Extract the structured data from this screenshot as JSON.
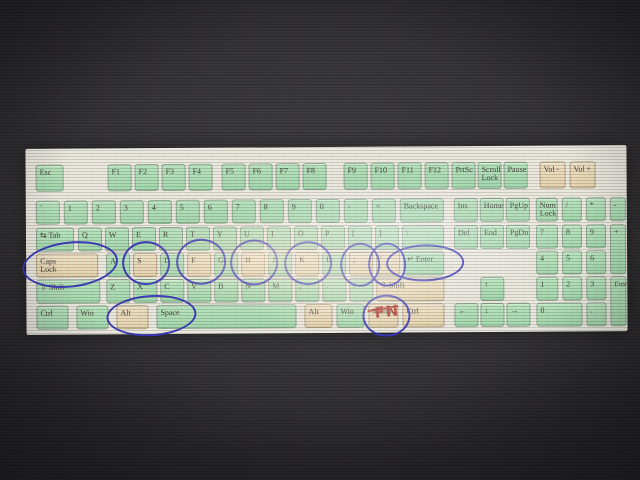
{
  "keyboard": {
    "keys": [
      {
        "id": "esc",
        "label": "Esc",
        "x": 10,
        "y": 16,
        "w": 28,
        "h": 27,
        "c": "g"
      },
      {
        "id": "f1",
        "label": "F1",
        "x": 82,
        "y": 16,
        "w": 24,
        "h": 27,
        "c": "g"
      },
      {
        "id": "f2",
        "label": "F2",
        "x": 109,
        "y": 16,
        "w": 24,
        "h": 27,
        "c": "g"
      },
      {
        "id": "f3",
        "label": "F3",
        "x": 136,
        "y": 16,
        "w": 24,
        "h": 27,
        "c": "g"
      },
      {
        "id": "f4",
        "label": "F4",
        "x": 163,
        "y": 16,
        "w": 24,
        "h": 27,
        "c": "g"
      },
      {
        "id": "f5",
        "label": "F5",
        "x": 196,
        "y": 16,
        "w": 24,
        "h": 27,
        "c": "g"
      },
      {
        "id": "f6",
        "label": "F6",
        "x": 223,
        "y": 16,
        "w": 24,
        "h": 27,
        "c": "g"
      },
      {
        "id": "f7",
        "label": "F7",
        "x": 250,
        "y": 16,
        "w": 24,
        "h": 27,
        "c": "g"
      },
      {
        "id": "f8",
        "label": "F8",
        "x": 277,
        "y": 16,
        "w": 24,
        "h": 27,
        "c": "g"
      },
      {
        "id": "f9",
        "label": "F9",
        "x": 318,
        "y": 16,
        "w": 24,
        "h": 27,
        "c": "g"
      },
      {
        "id": "f10",
        "label": "F10",
        "x": 345,
        "y": 16,
        "w": 24,
        "h": 27,
        "c": "g"
      },
      {
        "id": "f11",
        "label": "F11",
        "x": 372,
        "y": 16,
        "w": 24,
        "h": 27,
        "c": "g"
      },
      {
        "id": "f12",
        "label": "F12",
        "x": 399,
        "y": 16,
        "w": 24,
        "h": 27,
        "c": "g"
      },
      {
        "id": "prtsc",
        "label": "PrtSc",
        "x": 426,
        "y": 16,
        "w": 24,
        "h": 27,
        "c": "g"
      },
      {
        "id": "scroll-lock",
        "label": "Scroll",
        "label2": "Lock",
        "x": 452,
        "y": 16,
        "w": 24,
        "h": 27,
        "c": "g"
      },
      {
        "id": "pause",
        "label": "Pause",
        "x": 478,
        "y": 16,
        "w": 24,
        "h": 27,
        "c": "g"
      },
      {
        "id": "vol-minus",
        "label": "Vol -",
        "x": 514,
        "y": 16,
        "w": 26,
        "h": 27,
        "c": "b"
      },
      {
        "id": "vol-plus",
        "label": "Vol +",
        "x": 544,
        "y": 16,
        "w": 26,
        "h": 27,
        "c": "b"
      },
      {
        "id": "backtick",
        "label": "`",
        "x": 10,
        "y": 52,
        "w": 24,
        "h": 24,
        "c": "g"
      },
      {
        "id": "digit-1",
        "label": "1",
        "x": 38,
        "y": 52,
        "w": 24,
        "h": 24,
        "c": "g"
      },
      {
        "id": "digit-2",
        "label": "2",
        "x": 66,
        "y": 52,
        "w": 24,
        "h": 24,
        "c": "g"
      },
      {
        "id": "digit-3",
        "label": "3",
        "x": 94,
        "y": 52,
        "w": 24,
        "h": 24,
        "c": "g"
      },
      {
        "id": "digit-4",
        "label": "4",
        "x": 122,
        "y": 52,
        "w": 24,
        "h": 24,
        "c": "g"
      },
      {
        "id": "digit-5",
        "label": "5",
        "x": 150,
        "y": 52,
        "w": 24,
        "h": 24,
        "c": "g"
      },
      {
        "id": "digit-6",
        "label": "6",
        "x": 178,
        "y": 52,
        "w": 24,
        "h": 24,
        "c": "g"
      },
      {
        "id": "digit-7",
        "label": "7",
        "x": 206,
        "y": 52,
        "w": 24,
        "h": 24,
        "c": "g"
      },
      {
        "id": "digit-8",
        "label": "8",
        "x": 234,
        "y": 52,
        "w": 24,
        "h": 24,
        "c": "g"
      },
      {
        "id": "digit-9",
        "label": "9",
        "x": 262,
        "y": 52,
        "w": 24,
        "h": 24,
        "c": "g"
      },
      {
        "id": "digit-0",
        "label": "0",
        "x": 290,
        "y": 52,
        "w": 24,
        "h": 24,
        "c": "g"
      },
      {
        "id": "minus",
        "label": "-",
        "x": 318,
        "y": 52,
        "w": 24,
        "h": 24,
        "c": "g"
      },
      {
        "id": "equals",
        "label": "=",
        "x": 346,
        "y": 52,
        "w": 24,
        "h": 24,
        "c": "g"
      },
      {
        "id": "backspace",
        "label": "Backspace",
        "x": 374,
        "y": 52,
        "w": 44,
        "h": 24,
        "c": "g"
      },
      {
        "id": "ins",
        "label": "Ins",
        "x": 428,
        "y": 52,
        "w": 24,
        "h": 24,
        "c": "g"
      },
      {
        "id": "home",
        "label": "Home",
        "x": 454,
        "y": 52,
        "w": 24,
        "h": 24,
        "c": "g"
      },
      {
        "id": "pgup",
        "label": "PgUp",
        "x": 480,
        "y": 52,
        "w": 24,
        "h": 24,
        "c": "g"
      },
      {
        "id": "num-lock",
        "label": "Num",
        "label2": "Lock",
        "x": 510,
        "y": 52,
        "w": 22,
        "h": 24,
        "c": "g"
      },
      {
        "id": "np-divide",
        "label": "/",
        "x": 536,
        "y": 52,
        "w": 20,
        "h": 24,
        "c": "g"
      },
      {
        "id": "np-multiply",
        "label": "*",
        "x": 560,
        "y": 52,
        "w": 20,
        "h": 24,
        "c": "g"
      },
      {
        "id": "np-minus",
        "label": "-",
        "x": 584,
        "y": 52,
        "w": 16,
        "h": 24,
        "c": "g"
      },
      {
        "id": "tab",
        "label": "⇆ Tab",
        "x": 10,
        "y": 79,
        "w": 38,
        "h": 24,
        "c": "g"
      },
      {
        "id": "q",
        "label": "Q",
        "x": 52,
        "y": 79,
        "w": 24,
        "h": 24,
        "c": "g"
      },
      {
        "id": "w",
        "label": "W",
        "x": 79,
        "y": 79,
        "w": 24,
        "h": 24,
        "c": "g"
      },
      {
        "id": "e",
        "label": "E",
        "x": 106,
        "y": 79,
        "w": 24,
        "h": 24,
        "c": "g"
      },
      {
        "id": "r",
        "label": "R",
        "x": 133,
        "y": 79,
        "w": 24,
        "h": 24,
        "c": "g"
      },
      {
        "id": "t",
        "label": "T",
        "x": 160,
        "y": 79,
        "w": 24,
        "h": 24,
        "c": "g"
      },
      {
        "id": "y",
        "label": "Y",
        "x": 187,
        "y": 79,
        "w": 24,
        "h": 24,
        "c": "g"
      },
      {
        "id": "u",
        "label": "U",
        "x": 214,
        "y": 79,
        "w": 24,
        "h": 24,
        "c": "g"
      },
      {
        "id": "i",
        "label": "I",
        "x": 241,
        "y": 79,
        "w": 24,
        "h": 24,
        "c": "g"
      },
      {
        "id": "o",
        "label": "O",
        "x": 268,
        "y": 79,
        "w": 24,
        "h": 24,
        "c": "g"
      },
      {
        "id": "p",
        "label": "P",
        "x": 295,
        "y": 79,
        "w": 24,
        "h": 24,
        "c": "g"
      },
      {
        "id": "bracket-open",
        "label": "[",
        "x": 322,
        "y": 79,
        "w": 24,
        "h": 24,
        "c": "g"
      },
      {
        "id": "bracket-close",
        "label": "]",
        "x": 349,
        "y": 79,
        "w": 24,
        "h": 24,
        "c": "g"
      },
      {
        "id": "backslash",
        "label": "\\",
        "x": 376,
        "y": 79,
        "w": 42,
        "h": 24,
        "c": "g"
      },
      {
        "id": "del",
        "label": "Del",
        "x": 428,
        "y": 79,
        "w": 24,
        "h": 24,
        "c": "g"
      },
      {
        "id": "end",
        "label": "End",
        "x": 454,
        "y": 79,
        "w": 24,
        "h": 24,
        "c": "g"
      },
      {
        "id": "pgdn",
        "label": "PgDn",
        "x": 480,
        "y": 79,
        "w": 24,
        "h": 24,
        "c": "g"
      },
      {
        "id": "np-7",
        "label": "7",
        "x": 510,
        "y": 79,
        "w": 22,
        "h": 24,
        "c": "g"
      },
      {
        "id": "np-8",
        "label": "8",
        "x": 536,
        "y": 79,
        "w": 20,
        "h": 24,
        "c": "g"
      },
      {
        "id": "np-9",
        "label": "9",
        "x": 560,
        "y": 79,
        "w": 20,
        "h": 24,
        "c": "g"
      },
      {
        "id": "np-plus",
        "label": "+",
        "x": 584,
        "y": 79,
        "w": 16,
        "h": 50,
        "c": "g"
      },
      {
        "id": "caps-lock",
        "label": "Caps",
        "label2": "Lock",
        "x": 10,
        "y": 105,
        "w": 62,
        "h": 24,
        "c": "b"
      },
      {
        "id": "a",
        "label": "A",
        "x": 80,
        "y": 105,
        "w": 24,
        "h": 24,
        "c": "g"
      },
      {
        "id": "s",
        "label": "S",
        "x": 107,
        "y": 105,
        "w": 24,
        "h": 24,
        "c": "b"
      },
      {
        "id": "d",
        "label": "D",
        "x": 134,
        "y": 105,
        "w": 24,
        "h": 24,
        "c": "g"
      },
      {
        "id": "f",
        "label": "F",
        "x": 161,
        "y": 105,
        "w": 24,
        "h": 24,
        "c": "b"
      },
      {
        "id": "g",
        "label": "G",
        "x": 188,
        "y": 105,
        "w": 24,
        "h": 24,
        "c": "g"
      },
      {
        "id": "h",
        "label": "H",
        "x": 215,
        "y": 105,
        "w": 24,
        "h": 24,
        "c": "b"
      },
      {
        "id": "j",
        "label": "J",
        "x": 242,
        "y": 105,
        "w": 24,
        "h": 24,
        "c": "g"
      },
      {
        "id": "k",
        "label": "K",
        "x": 269,
        "y": 105,
        "w": 24,
        "h": 24,
        "c": "b"
      },
      {
        "id": "l",
        "label": "L",
        "x": 296,
        "y": 105,
        "w": 24,
        "h": 24,
        "c": "g"
      },
      {
        "id": "semicolon",
        "label": ";",
        "x": 323,
        "y": 105,
        "w": 24,
        "h": 24,
        "c": "b"
      },
      {
        "id": "apostrophe",
        "label": "'",
        "x": 350,
        "y": 105,
        "w": 24,
        "h": 24,
        "c": "b"
      },
      {
        "id": "enter",
        "label": "↵ Enter",
        "x": 377,
        "y": 105,
        "w": 41,
        "h": 24,
        "c": "g"
      },
      {
        "id": "np-4",
        "label": "4",
        "x": 510,
        "y": 105,
        "w": 22,
        "h": 24,
        "c": "g"
      },
      {
        "id": "np-5",
        "label": "5",
        "x": 536,
        "y": 105,
        "w": 20,
        "h": 24,
        "c": "g"
      },
      {
        "id": "np-6",
        "label": "6",
        "x": 560,
        "y": 105,
        "w": 20,
        "h": 24,
        "c": "g"
      },
      {
        "id": "left-shift",
        "label": "⇧ Shift",
        "x": 10,
        "y": 131,
        "w": 64,
        "h": 24,
        "c": "g"
      },
      {
        "id": "z",
        "label": "Z",
        "x": 80,
        "y": 131,
        "w": 24,
        "h": 24,
        "c": "g"
      },
      {
        "id": "x",
        "label": "X",
        "x": 107,
        "y": 131,
        "w": 24,
        "h": 24,
        "c": "g"
      },
      {
        "id": "c",
        "label": "C",
        "x": 134,
        "y": 131,
        "w": 24,
        "h": 24,
        "c": "g"
      },
      {
        "id": "v",
        "label": "V",
        "x": 161,
        "y": 131,
        "w": 24,
        "h": 24,
        "c": "g"
      },
      {
        "id": "b",
        "label": "B",
        "x": 188,
        "y": 131,
        "w": 24,
        "h": 24,
        "c": "g"
      },
      {
        "id": "n",
        "label": "N",
        "x": 215,
        "y": 131,
        "w": 24,
        "h": 24,
        "c": "g"
      },
      {
        "id": "m",
        "label": "M",
        "x": 242,
        "y": 131,
        "w": 24,
        "h": 24,
        "c": "g"
      },
      {
        "id": "comma",
        "label": ",",
        "x": 269,
        "y": 131,
        "w": 24,
        "h": 24,
        "c": "g"
      },
      {
        "id": "period",
        "label": ".",
        "x": 296,
        "y": 131,
        "w": 24,
        "h": 24,
        "c": "g"
      },
      {
        "id": "slash",
        "label": "/",
        "x": 323,
        "y": 131,
        "w": 24,
        "h": 24,
        "c": "g"
      },
      {
        "id": "right-shift",
        "label": "⇧ Shift",
        "x": 350,
        "y": 131,
        "w": 68,
        "h": 24,
        "c": "b"
      },
      {
        "id": "arrow-up",
        "label": "↑",
        "x": 454,
        "y": 131,
        "w": 24,
        "h": 24,
        "c": "g"
      },
      {
        "id": "np-1",
        "label": "1",
        "x": 510,
        "y": 131,
        "w": 22,
        "h": 24,
        "c": "g"
      },
      {
        "id": "np-2",
        "label": "2",
        "x": 536,
        "y": 131,
        "w": 20,
        "h": 24,
        "c": "g"
      },
      {
        "id": "np-3",
        "label": "3",
        "x": 560,
        "y": 131,
        "w": 20,
        "h": 24,
        "c": "g"
      },
      {
        "id": "np-enter",
        "label": "Enter",
        "italic": true,
        "x": 584,
        "y": 131,
        "w": 16,
        "h": 50,
        "c": "g"
      },
      {
        "id": "left-ctrl",
        "label": "Ctrl",
        "x": 10,
        "y": 157,
        "w": 32,
        "h": 24,
        "c": "g"
      },
      {
        "id": "left-win",
        "label": "Win",
        "x": 50,
        "y": 157,
        "w": 32,
        "h": 24,
        "c": "g"
      },
      {
        "id": "left-alt",
        "label": "Alt",
        "x": 90,
        "y": 157,
        "w": 32,
        "h": 24,
        "c": "b"
      },
      {
        "id": "space",
        "label": "Space",
        "x": 130,
        "y": 157,
        "w": 140,
        "h": 24,
        "c": "g"
      },
      {
        "id": "right-alt",
        "label": "Alt",
        "x": 278,
        "y": 157,
        "w": 28,
        "h": 24,
        "c": "b"
      },
      {
        "id": "right-win",
        "label": "Win",
        "x": 310,
        "y": 157,
        "w": 28,
        "h": 24,
        "c": "g"
      },
      {
        "id": "menu",
        "label": "Menu",
        "x": 342,
        "y": 157,
        "w": 30,
        "h": 24,
        "c": "b"
      },
      {
        "id": "right-ctrl",
        "label": "Ctrl",
        "x": 376,
        "y": 157,
        "w": 42,
        "h": 24,
        "c": "b"
      },
      {
        "id": "arrow-left",
        "label": "←",
        "x": 428,
        "y": 157,
        "w": 24,
        "h": 24,
        "c": "g"
      },
      {
        "id": "arrow-down",
        "label": "↓",
        "x": 454,
        "y": 157,
        "w": 24,
        "h": 24,
        "c": "g"
      },
      {
        "id": "arrow-right",
        "label": "→",
        "x": 480,
        "y": 157,
        "w": 24,
        "h": 24,
        "c": "g"
      },
      {
        "id": "np-0",
        "label": "0",
        "x": 510,
        "y": 157,
        "w": 46,
        "h": 24,
        "c": "g"
      },
      {
        "id": "np-dot",
        "label": ".",
        "x": 560,
        "y": 157,
        "w": 20,
        "h": 24,
        "c": "g"
      }
    ]
  },
  "annotations": {
    "pen_blue": "#3434b8",
    "pen_red": "#b03226",
    "fn_label": "FN",
    "items": [
      {
        "type": "ellipse",
        "name": "circle-caps-lock",
        "x": -4,
        "y": 93,
        "w": 92,
        "h": 42,
        "rot": -6
      },
      {
        "type": "ellipse",
        "name": "circle-s",
        "x": 96,
        "y": 93,
        "w": 44,
        "h": 40,
        "rot": 2
      },
      {
        "type": "ellipse",
        "name": "circle-f",
        "x": 150,
        "y": 91,
        "w": 46,
        "h": 42,
        "rot": -2
      },
      {
        "type": "ellipse",
        "name": "circle-h",
        "x": 204,
        "y": 92,
        "w": 44,
        "h": 42,
        "rot": 1
      },
      {
        "type": "ellipse",
        "name": "circle-k",
        "x": 258,
        "y": 94,
        "w": 44,
        "h": 40,
        "rot": -1
      },
      {
        "type": "ellipse",
        "name": "circle-semicolon",
        "x": 314,
        "y": 96,
        "w": 36,
        "h": 40,
        "rot": 2
      },
      {
        "type": "ellipse",
        "name": "circle-apostrophe",
        "x": 342,
        "y": 96,
        "w": 34,
        "h": 40,
        "rot": -2
      },
      {
        "type": "ellipse",
        "name": "circle-enter",
        "x": 360,
        "y": 98,
        "w": 74,
        "h": 33,
        "rot": -1
      },
      {
        "type": "ellipse",
        "name": "circle-alt-space",
        "x": 80,
        "y": 147,
        "w": 86,
        "h": 37,
        "rot": -3
      },
      {
        "type": "ellipse",
        "name": "circle-menu",
        "x": 336,
        "y": 148,
        "w": 44,
        "h": 38,
        "rot": 0
      },
      {
        "type": "line",
        "name": "red-strike-menu",
        "x": 341,
        "y": 161,
        "w": 31,
        "rot": -9
      },
      {
        "type": "text",
        "name": "red-fn-label",
        "text": "FN",
        "x": 348,
        "y": 156,
        "rot": -6
      }
    ]
  }
}
